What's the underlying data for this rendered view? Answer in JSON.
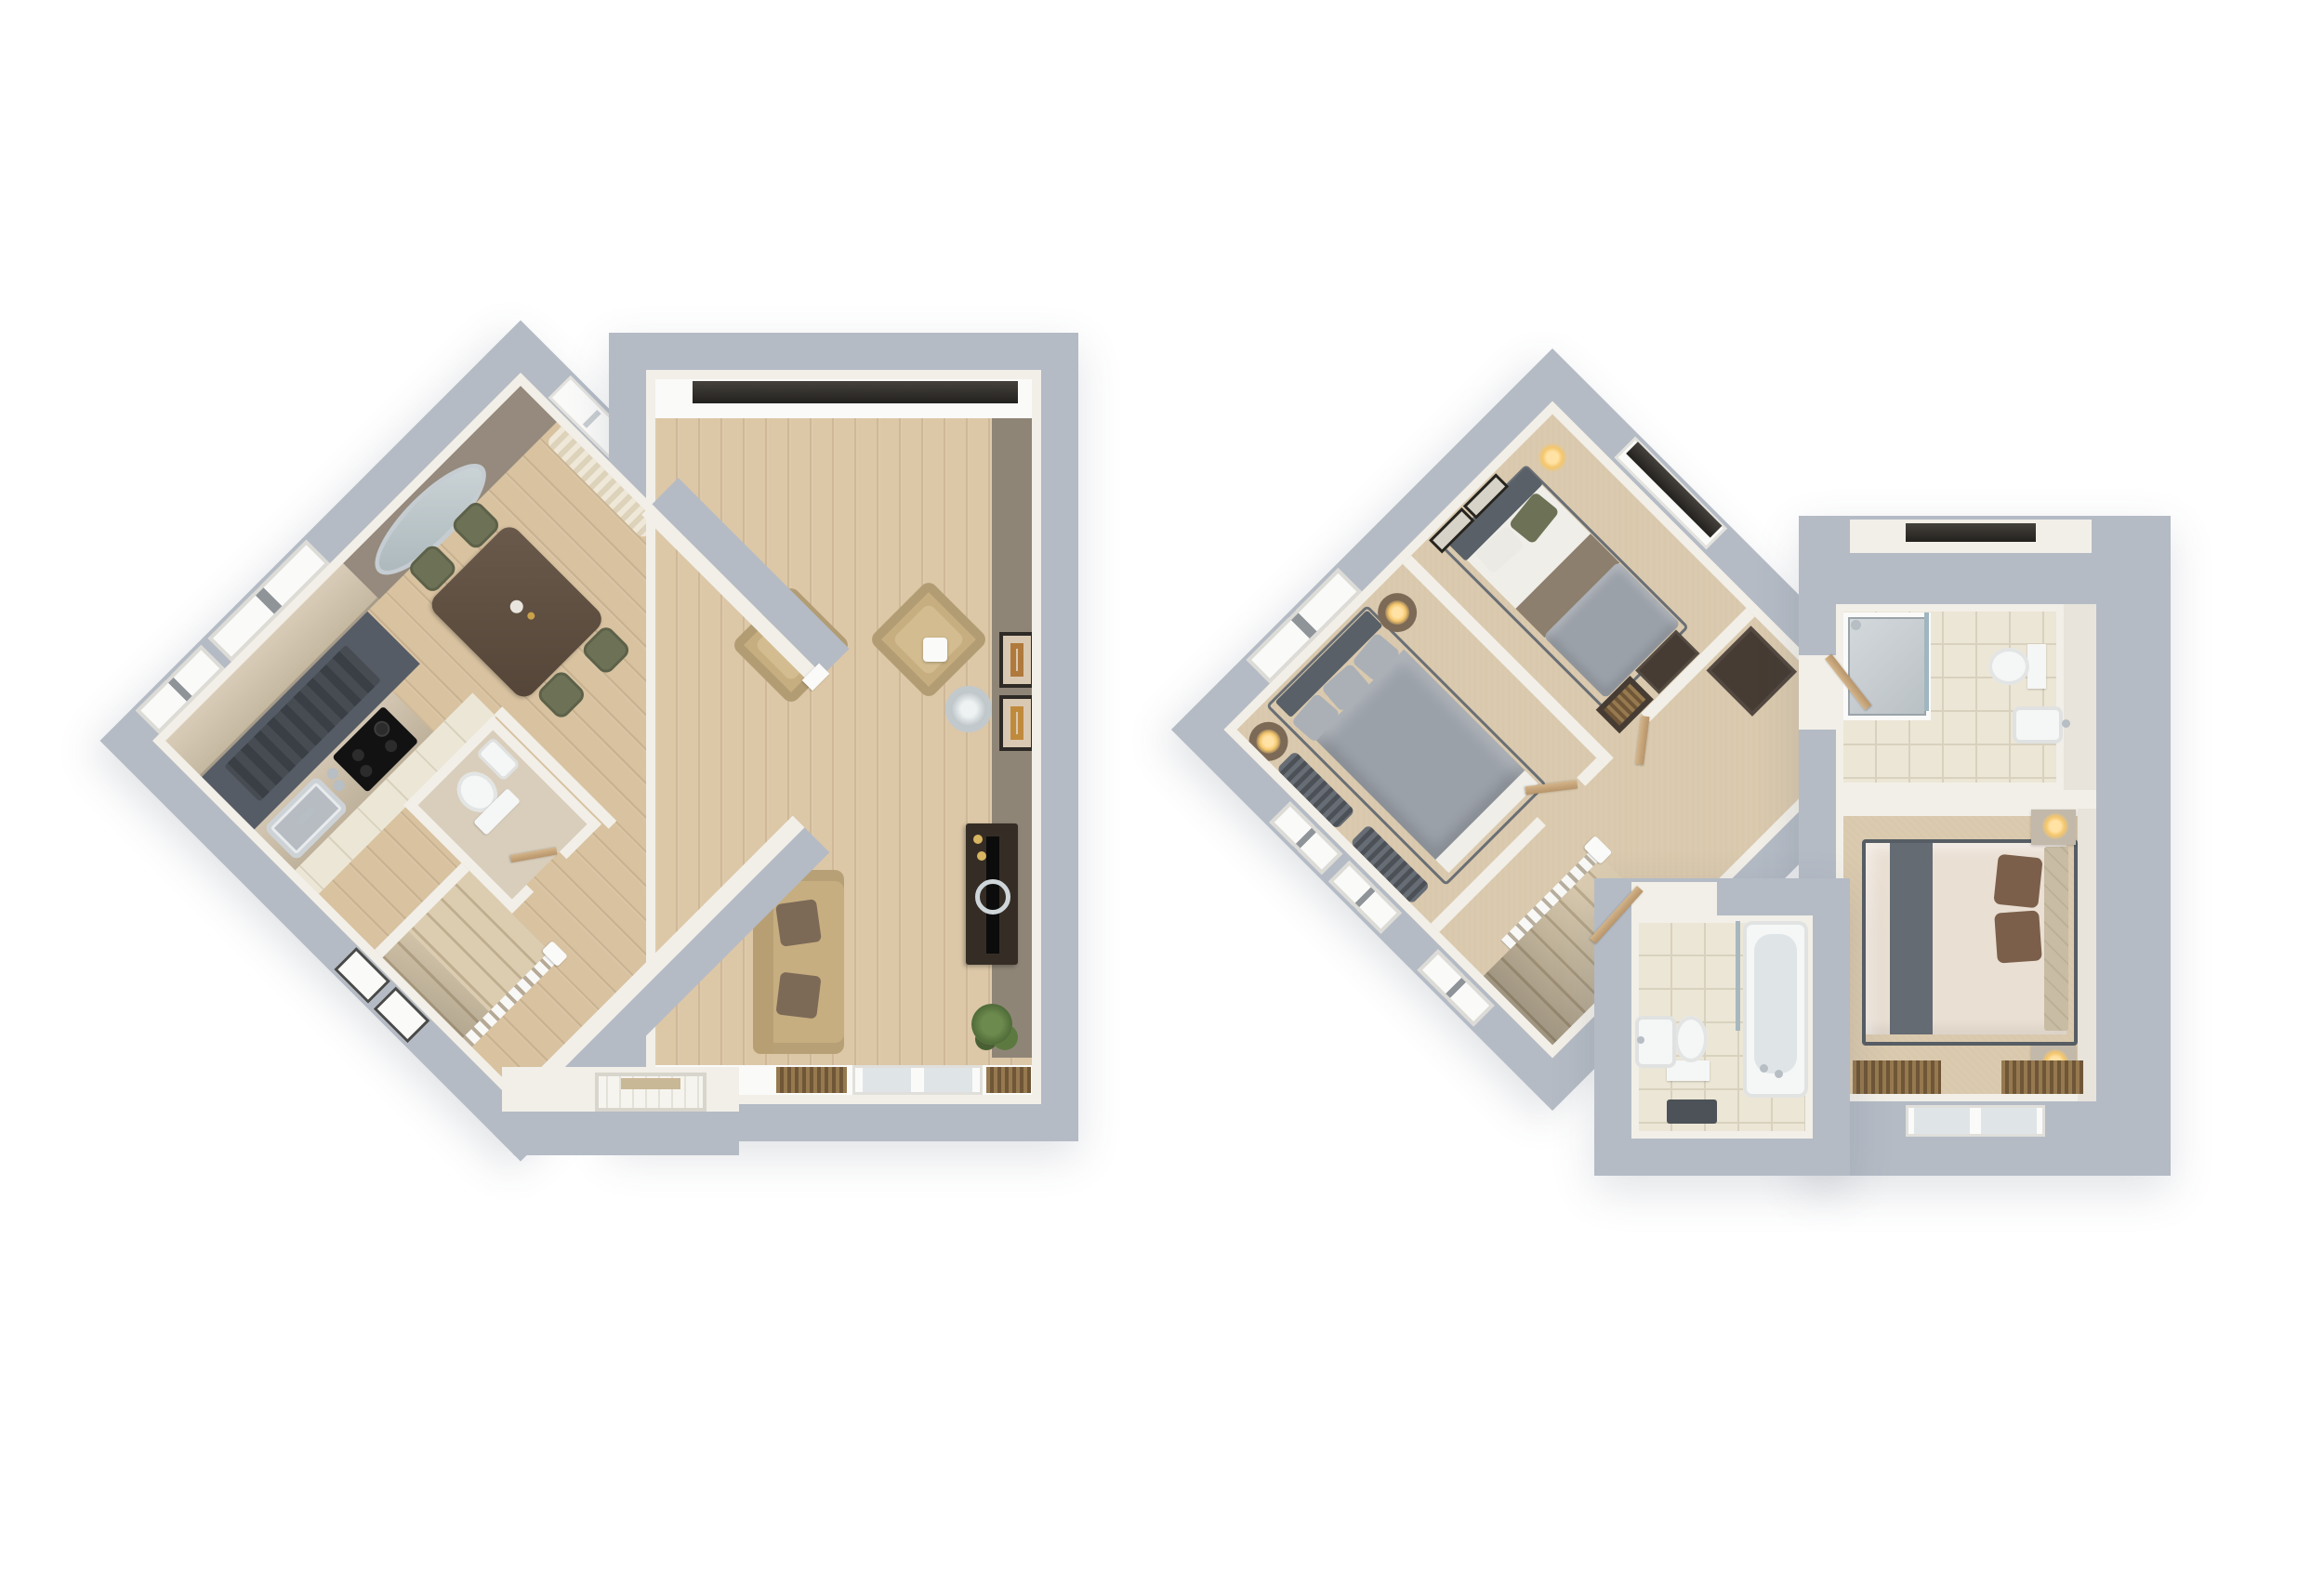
{
  "document": {
    "kind": "3d-floorplan-pair",
    "text_labels": [],
    "background": "#ffffff"
  },
  "palette": {
    "wall": "#b4bbc5",
    "wallface": "#f2efe8",
    "white": "#fafaf9",
    "wood": "#d8c2a0",
    "woodliving": "#dcc7a7",
    "carpet": "#d9c8ac",
    "tile": "#ece6d6",
    "grout": "#d8d1be",
    "slate": "#565c66",
    "runner": "#41464d",
    "cabinet": "#cec1ac",
    "counter": "#cabfab",
    "taupe": "#958a7d",
    "accent": "#8f8577",
    "sofa": "#c7ae80",
    "cushion": "#7c6a57",
    "graybed": "#9ba1a9",
    "headboard": "#596067",
    "sheet": "#f0eee8",
    "blanket": "#8d7f6e",
    "creambed": "#eadfd3",
    "runnergray": "#646b73",
    "pillowbrown": "#7b5f4a",
    "headboardtan": "#c8bca5",
    "olive": "#6d7256",
    "plant": "#5c7a40",
    "tabledark": "#5c4c3e",
    "darkwood": "#463c33",
    "tvdark": "#352d25",
    "fixture": "#f5f6f6",
    "glass": "#dfe5e7",
    "chrome": "#b7bec4",
    "lampglow": "#f5c76d",
    "blind": "#8a6e51",
    "lintel": "#33302b",
    "curtain": "#565c63",
    "matdark": "#4c5258",
    "doorwood": "#c9a87a"
  },
  "floors": [
    {
      "id": "ground-floor",
      "orientation": "diamond-plus-rectangle",
      "rooms": [
        {
          "name": "kitchen-dining",
          "floor": "wood-and-tile",
          "furniture": [
            "oval-wall-mirror",
            "dining-table",
            "four-green-chairs",
            "curtained-window",
            "kitchen-cabinets",
            "worktop-island",
            "hob",
            "sink",
            "runner-mat"
          ]
        },
        {
          "name": "living-room",
          "floor": "wood",
          "furniture": [
            "two-armchairs",
            "arc-floor-lamp",
            "sofa-with-cushions",
            "tv-unit",
            "tv",
            "plant",
            "two-picture-frames",
            "window-with-blind",
            "french-doors",
            "two-radiator-blinds"
          ]
        },
        {
          "name": "wc",
          "floor": "vinyl",
          "furniture": [
            "toilet",
            "basin"
          ]
        },
        {
          "name": "hallway",
          "floor": "wood",
          "furniture": [
            "staircase-with-railing",
            "front-door",
            "stair-windows"
          ]
        }
      ]
    },
    {
      "id": "first-floor",
      "orientation": "diamond-plus-rectangle",
      "rooms": [
        {
          "name": "bedroom-3-single",
          "floor": "carpet",
          "furniture": [
            "single-bed",
            "green-pillow",
            "bedside-lamp",
            "two-picture-frames",
            "dresser",
            "open-wardrobe",
            "window-with-blind"
          ]
        },
        {
          "name": "bedroom-1-double",
          "floor": "carpet",
          "furniture": [
            "double-bed",
            "four-pillows",
            "two-round-bedside-tables",
            "two-lamps",
            "pooled-curtains",
            "two-windows"
          ]
        },
        {
          "name": "landing",
          "floor": "carpet",
          "furniture": [
            "staircase-with-railing",
            "cupboard",
            "window"
          ]
        },
        {
          "name": "en-suite",
          "floor": "tile",
          "furniture": [
            "shower-enclosure",
            "toilet",
            "basin",
            "door"
          ]
        },
        {
          "name": "master-bedroom",
          "floor": "carpet",
          "furniture": [
            "double-bed-cream",
            "grey-runner",
            "brown-pillows",
            "padded-headboard",
            "two-bedside-tables",
            "two-lamps",
            "venetian-blinds",
            "window"
          ]
        },
        {
          "name": "bathroom",
          "floor": "tile",
          "furniture": [
            "bath-with-taps",
            "shower-screen",
            "toilet",
            "basin",
            "bath-mat",
            "door"
          ]
        }
      ]
    }
  ]
}
